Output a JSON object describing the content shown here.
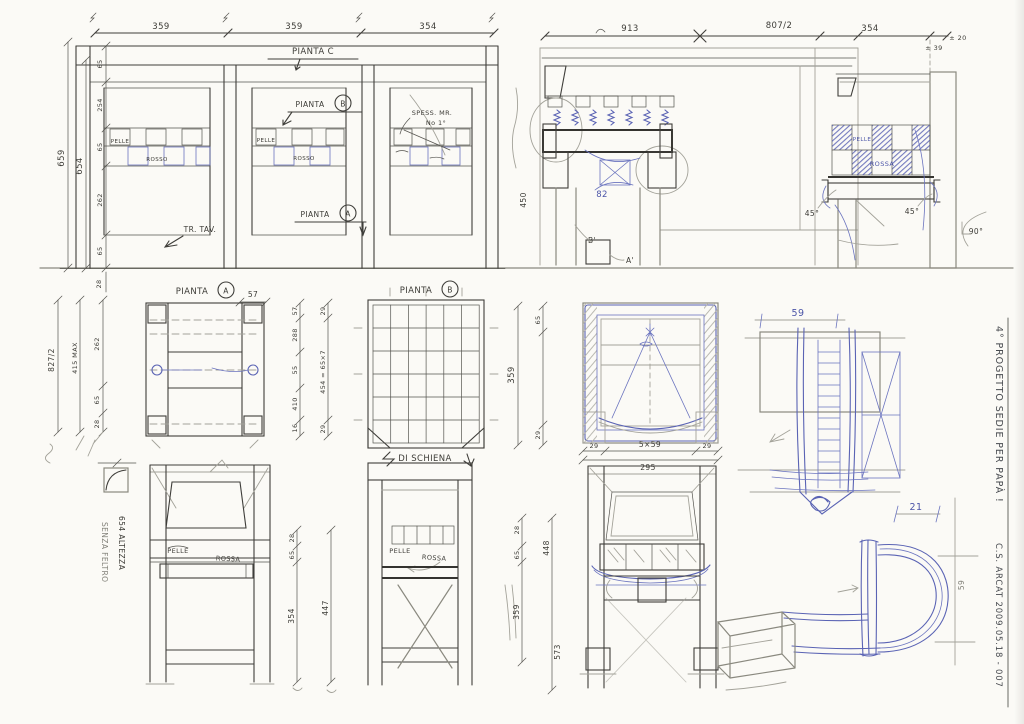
{
  "titleblock": {
    "project": "4° PROGETTO    SEDIE PER PAPÀ !",
    "author_date": "C.S. ARCAT    2009.05.18 - 007"
  },
  "plans": {
    "pianta_c": "PIANTA C",
    "pianta": "PIANTA",
    "a": "A",
    "b": "B",
    "di_schiena": "DI SCHIENA",
    "tr_tav": "TR. TAV.",
    "note1": "SPESS. MR.",
    "note2": "No 1°"
  },
  "materials": {
    "pelle": "PELLE",
    "rosso": "ROSSO",
    "rossa": "ROSSA"
  },
  "angles": {
    "a45": "45°",
    "a90": "90°"
  },
  "marks": {
    "n82": "82",
    "b_prime": "B'",
    "a_prime": "A'"
  },
  "dims": {
    "bay1": "359",
    "bay2": "359",
    "bay3": "354",
    "w913": "913",
    "w807": "807/2",
    "w354": "354",
    "pm39": "± 39",
    "pm20": "± 20",
    "h659": "659",
    "h654": "654",
    "lchain": [
      "65",
      "254",
      "65",
      "262",
      "65"
    ],
    "l28": "28",
    "m827": "827/2",
    "m415": "415 MAX",
    "m262": "262",
    "m65": "65",
    "m28": "28",
    "a57": "57",
    "achain": [
      "57",
      "288",
      "55",
      "410",
      "16"
    ],
    "a29": "29",
    "a454": "454 = 65×7",
    "b359": "359",
    "b65": "65",
    "b29": "29",
    "p559": "5×59",
    "p295": "295",
    "p29": "29",
    "s59": "59",
    "c1": {
      "d28": "28",
      "d65": "65",
      "d354": "354",
      "d447": "447"
    },
    "c2": {
      "d28": "28",
      "d65": "65",
      "d359": "359",
      "d448": "448",
      "d573": "573"
    },
    "d21": "21",
    "d59": "59",
    "sec450": "450"
  },
  "notes": {
    "senza": "SENZA FELTRO",
    "altezza": "654 ALTEZZA"
  }
}
